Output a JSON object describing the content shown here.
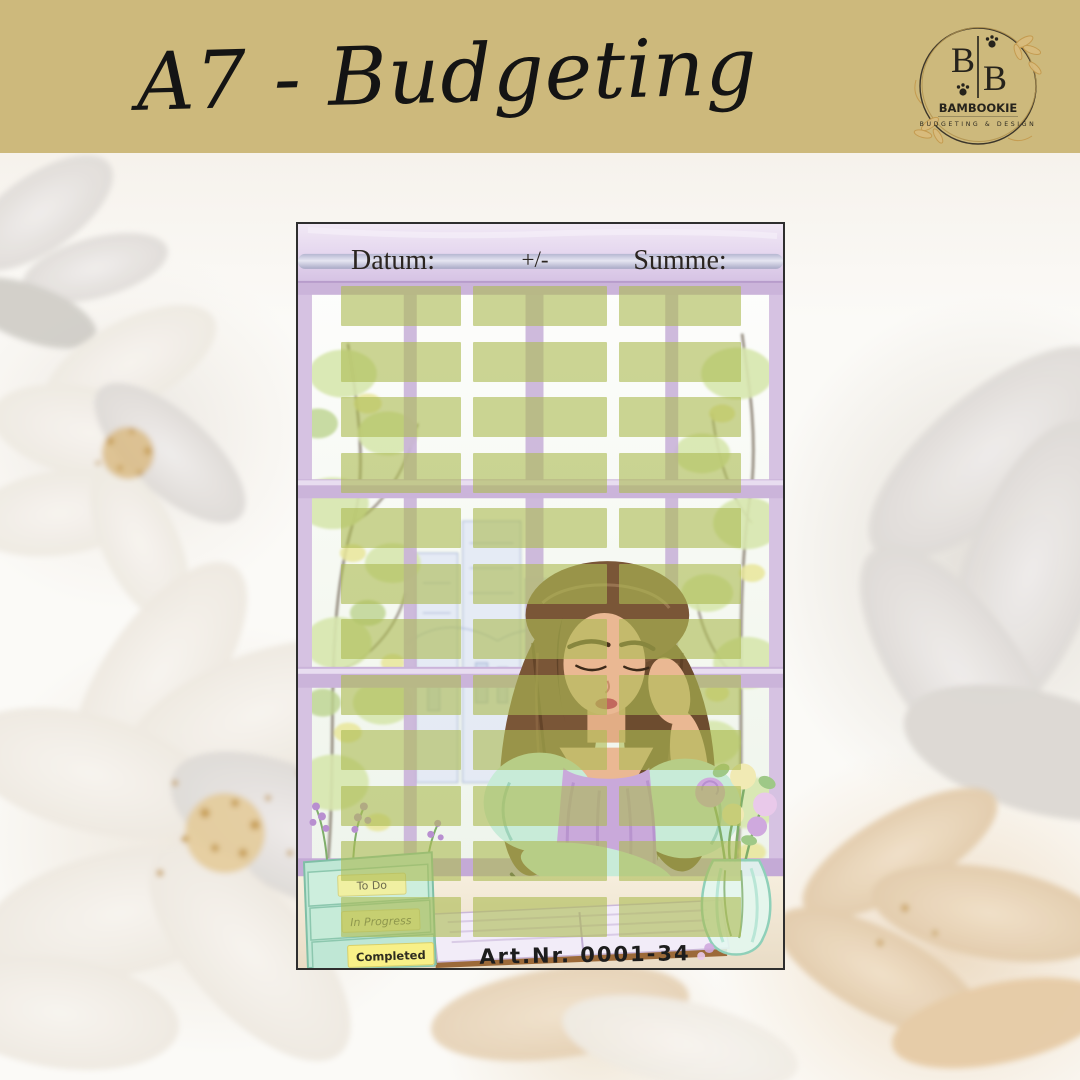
{
  "palette": {
    "band_gold": "#cdb97c",
    "sticker_green": "rgba(173,188,84,0.62)",
    "window_lavender": "#c8b0d8",
    "valance_lavender": "#e4d6ee",
    "mint_box": "#c5ead9",
    "tab_yellow": "#f0f0a2",
    "gold_accent": "#c49a4e"
  },
  "band": {
    "title": "A7 - Budgeting"
  },
  "logo": {
    "monogram_left": "B",
    "monogram_right": "B",
    "brand": "BAMBOOKIE",
    "tagline": "BUDGETING & DESIGN"
  },
  "sheet": {
    "header": {
      "date_label": "Datum:",
      "sign_label": "+/-",
      "sum_label": "Summe:"
    },
    "sticker_grid": {
      "rows": 12,
      "columns": 3
    },
    "sorter_tabs": {
      "todo": "To Do",
      "in_progress": "In Progress",
      "completed": "Completed"
    },
    "art_number": "Art.Nr. 0001-34"
  }
}
